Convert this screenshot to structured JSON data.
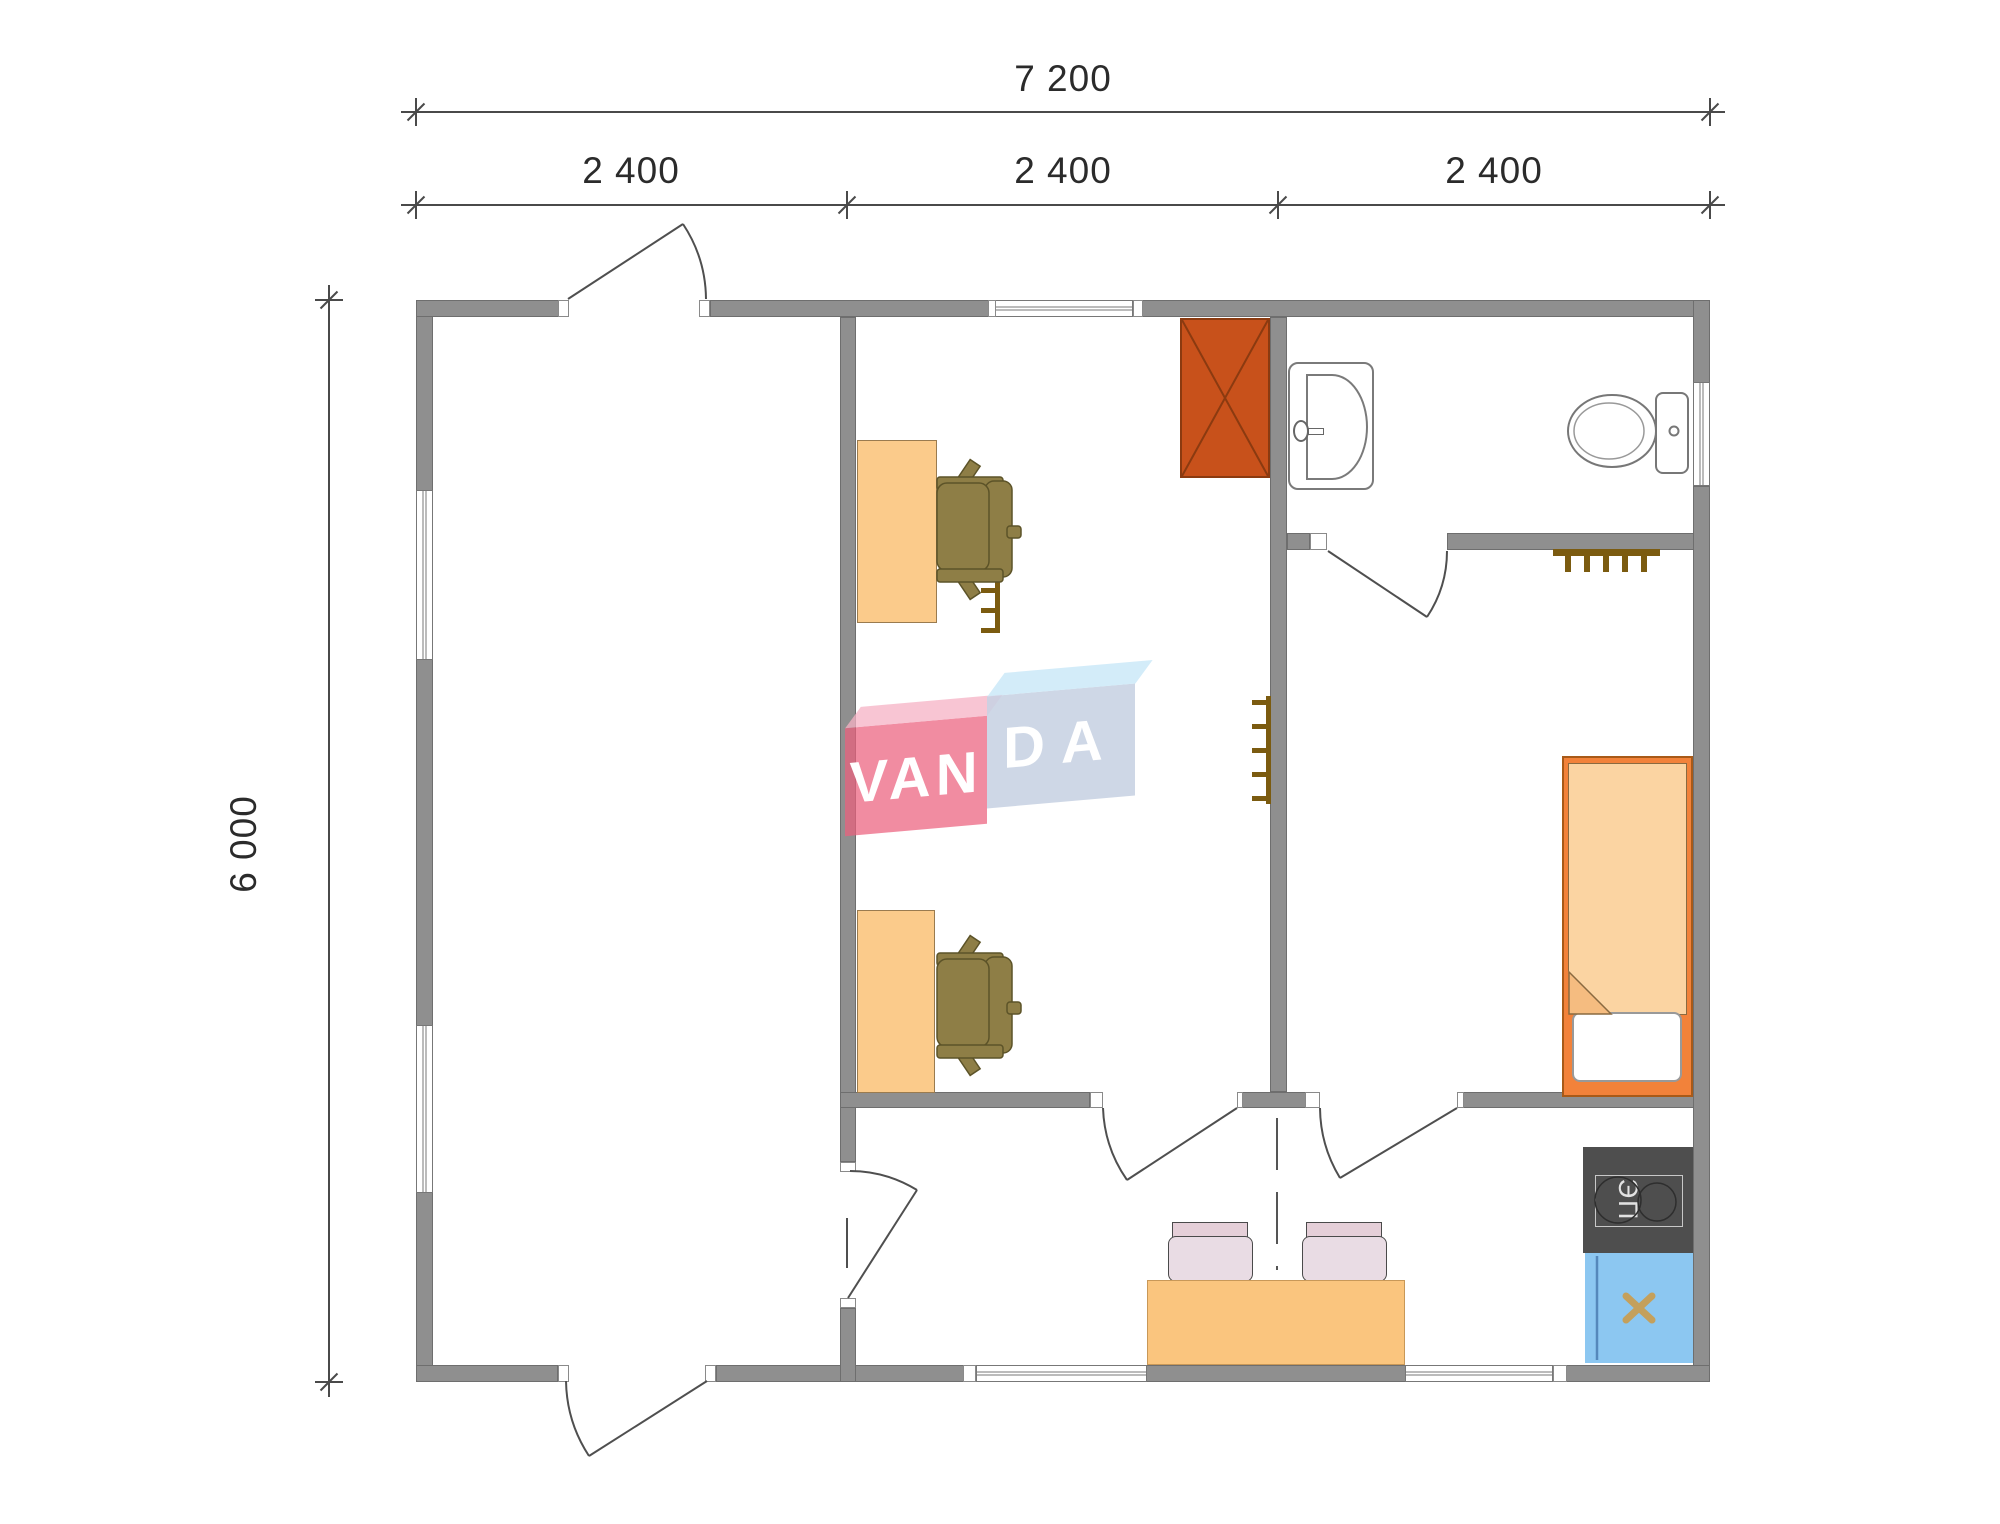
{
  "dimensions": {
    "total_width": "7 200",
    "segments": [
      "2 400",
      "2 400",
      "2 400"
    ],
    "height": "6 000"
  },
  "logo": {
    "left": "VAN",
    "right": "DA"
  },
  "kitchen": {
    "stove_label": "ЭП"
  },
  "colors": {
    "wall_gray": "#8F8F8F",
    "furniture_orange": "#FBCB8B",
    "wardrobe_red": "#C8511B",
    "bed_frame_orange": "#F2823A",
    "bed_blanket": "#FBD4A2",
    "kitchen_sink_blue": "#8CC7F1",
    "stove_dark_gray": "#4E4E4E",
    "office_chair_olive": "#8E7E46",
    "dining_chair_pink": "#E9DCE4",
    "radiator_brown": "#7B5B10",
    "logo_pink": "#EB5F7D",
    "logo_blue": "#C7D2E3",
    "dimension_text": "#2b2b2b"
  }
}
